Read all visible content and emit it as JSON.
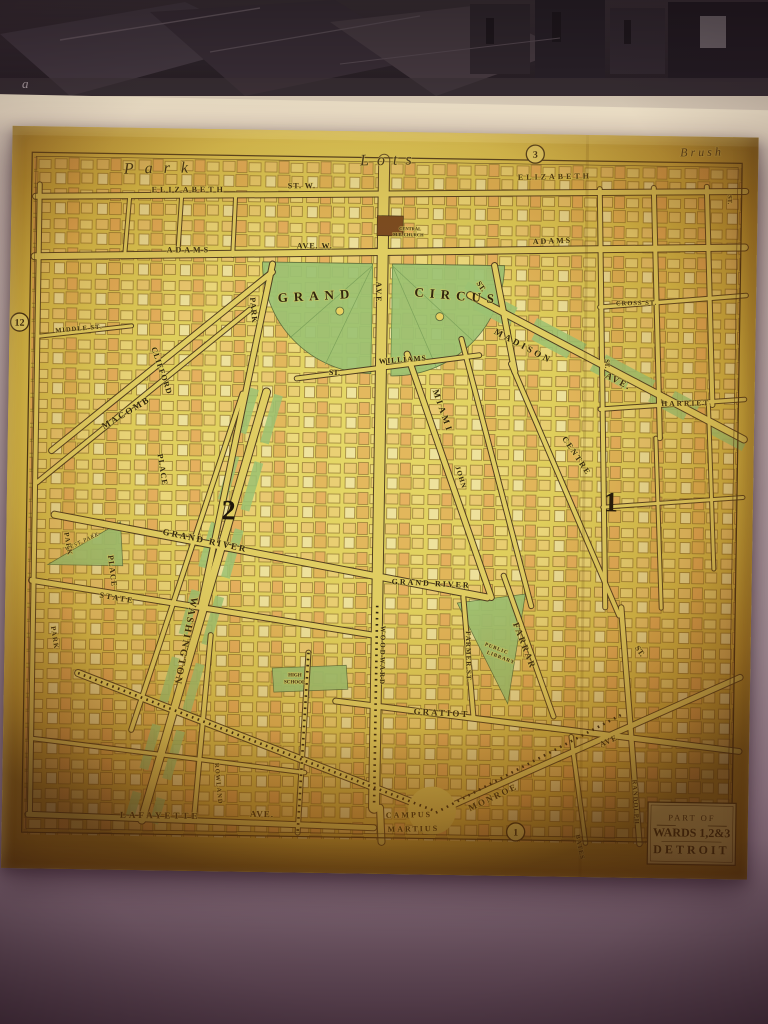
{
  "photo": {
    "mark": "a"
  },
  "map": {
    "cartouche": {
      "line1": "PART OF",
      "line2": "WARDS 1,2&3",
      "line3": "DETROIT"
    },
    "circled": [
      {
        "n": "3",
        "x": 523,
        "y": 20
      },
      {
        "n": "12",
        "x": 10,
        "y": 196
      },
      {
        "n": "1",
        "x": 514,
        "y": 698
      }
    ],
    "numerals": [
      {
        "n": "2",
        "x": 222,
        "y": 390
      },
      {
        "n": "1",
        "x": 604,
        "y": 376
      }
    ],
    "labels": [
      {
        "t": "Park",
        "x": 112,
        "y": 46,
        "r": -2,
        "s": 16,
        "it": 1,
        "sp": 11
      },
      {
        "t": "Lots",
        "x": 348,
        "y": 34,
        "r": -2,
        "s": 16,
        "it": 1,
        "sp": 8
      },
      {
        "t": "Brush",
        "x": 668,
        "y": 20,
        "r": -2,
        "s": 12,
        "it": 1,
        "sp": 3
      },
      {
        "t": "ELIZABETH",
        "x": 140,
        "y": 64,
        "r": -1,
        "s": 8,
        "sp": 3
      },
      {
        "t": "ST. W.",
        "x": 276,
        "y": 58,
        "r": -1,
        "s": 8,
        "sp": 1
      },
      {
        "t": "ELIZABETH",
        "x": 506,
        "y": 46,
        "r": -2,
        "s": 8,
        "sp": 3
      },
      {
        "t": "ADAMS",
        "x": 156,
        "y": 124,
        "r": -1,
        "s": 8,
        "sp": 3
      },
      {
        "t": "AVE. W.",
        "x": 286,
        "y": 118,
        "r": -1,
        "s": 8,
        "sp": 1
      },
      {
        "t": "ADAMS",
        "x": 522,
        "y": 110,
        "r": -3,
        "s": 8,
        "sp": 2
      },
      {
        "t": "GRAND",
        "x": 268,
        "y": 172,
        "r": -4,
        "s": 13,
        "sp": 6
      },
      {
        "t": "CIRCUS",
        "x": 404,
        "y": 164,
        "r": 4,
        "s": 13,
        "sp": 6
      },
      {
        "t": "MADISON",
        "x": 484,
        "y": 200,
        "r": 27,
        "s": 9,
        "sp": 3
      },
      {
        "t": "AVE.",
        "x": 596,
        "y": 242,
        "r": 27,
        "s": 9,
        "sp": 2
      },
      {
        "t": "CROSS ST.",
        "x": 606,
        "y": 170,
        "r": -2,
        "s": 6.5,
        "sp": 1
      },
      {
        "t": "HARRIET",
        "x": 653,
        "y": 270,
        "r": -2,
        "s": 7.5,
        "sp": 2
      },
      {
        "t": "ST.",
        "x": 320,
        "y": 244,
        "r": 0,
        "s": 8,
        "sp": 0
      },
      {
        "t": "WILLIAMS",
        "x": 370,
        "y": 232,
        "r": -5,
        "s": 7.5,
        "sp": 1
      },
      {
        "t": "ST.",
        "x": 466,
        "y": 150,
        "r": 55,
        "s": 7.5,
        "sp": 0
      },
      {
        "t": "MIAMI",
        "x": 424,
        "y": 258,
        "r": 70,
        "s": 9,
        "sp": 3
      },
      {
        "t": "JOHN",
        "x": 448,
        "y": 334,
        "r": 72,
        "s": 7,
        "sp": 1
      },
      {
        "t": "CENTRE",
        "x": 554,
        "y": 304,
        "r": 55,
        "s": 8,
        "sp": 2
      },
      {
        "t": "ST.",
        "x": 630,
        "y": 512,
        "r": 55,
        "s": 8,
        "sp": 0
      },
      {
        "t": "AVE",
        "x": 366,
        "y": 150,
        "r": 90,
        "s": 8,
        "sp": 2
      },
      {
        "t": "WOODWARD",
        "x": 376,
        "y": 494,
        "r": 90,
        "s": 7,
        "sp": 2
      },
      {
        "t": "PARK",
        "x": 240,
        "y": 168,
        "r": 84,
        "s": 8,
        "sp": 1
      },
      {
        "t": "CLIFFORD",
        "x": 142,
        "y": 220,
        "r": 70,
        "s": 8,
        "sp": 1
      },
      {
        "t": "MACOMB",
        "x": 96,
        "y": 302,
        "r": -32,
        "s": 9,
        "sp": 2
      },
      {
        "t": "MIDDLE ST.",
        "x": 46,
        "y": 206,
        "r": -6,
        "s": 6.5,
        "sp": 1
      },
      {
        "t": "PLACE",
        "x": 150,
        "y": 326,
        "r": 80,
        "s": 8,
        "sp": 1
      },
      {
        "t": "PLACE",
        "x": 102,
        "y": 428,
        "r": 82,
        "s": 8,
        "sp": 1
      },
      {
        "t": "PARK",
        "x": 58,
        "y": 406,
        "r": 80,
        "s": 7,
        "sp": 1
      },
      {
        "t": "PARK",
        "x": 46,
        "y": 500,
        "r": 80,
        "s": 7,
        "sp": 1
      },
      {
        "t": "WEST PARK",
        "x": 60,
        "y": 424,
        "r": -26,
        "s": 5.5,
        "it": 1,
        "sp": 1
      },
      {
        "t": "WASHINGTON",
        "x": 186,
        "y": 468,
        "r": 100,
        "s": 10,
        "sp": 2
      },
      {
        "t": "GRAND RIVER",
        "x": 156,
        "y": 406,
        "r": 11,
        "s": 9,
        "sp": 2
      },
      {
        "t": "GRAND RIVER",
        "x": 386,
        "y": 452,
        "r": 2,
        "s": 8,
        "sp": 2
      },
      {
        "t": "STATE",
        "x": 94,
        "y": 470,
        "r": 9,
        "s": 8,
        "sp": 2
      },
      {
        "t": "FARMER ST.",
        "x": 461,
        "y": 498,
        "r": 88,
        "s": 7,
        "sp": 1
      },
      {
        "t": "FARRAR",
        "x": 508,
        "y": 490,
        "r": 68,
        "s": 9,
        "sp": 2
      },
      {
        "t": "PUBLIC",
        "x": 480,
        "y": 512,
        "r": 20,
        "s": 5,
        "sp": 1
      },
      {
        "t": "LIBRARY",
        "x": 482,
        "y": 520,
        "r": 20,
        "s": 5,
        "sp": 1
      },
      {
        "t": "GRATIOT",
        "x": 410,
        "y": 582,
        "r": 2,
        "s": 9,
        "sp": 2
      },
      {
        "t": "MONROE",
        "x": 468,
        "y": 678,
        "r": -26,
        "s": 9,
        "sp": 2
      },
      {
        "t": "AVE",
        "x": 598,
        "y": 612,
        "r": -26,
        "s": 8,
        "sp": 1
      },
      {
        "t": "CAMPUS",
        "x": 384,
        "y": 686,
        "r": -2,
        "s": 8,
        "sp": 2
      },
      {
        "t": "MARTIUS",
        "x": 386,
        "y": 700,
        "r": -2,
        "s": 8,
        "sp": 2
      },
      {
        "t": "LAFAYETTE",
        "x": 118,
        "y": 690,
        "r": 0,
        "s": 9,
        "sp": 3
      },
      {
        "t": "AVE.",
        "x": 248,
        "y": 687,
        "r": 0,
        "s": 9,
        "sp": 1
      },
      {
        "t": "BATES",
        "x": 574,
        "y": 700,
        "r": 78,
        "s": 6.5,
        "sp": 1
      },
      {
        "t": "RANDOLPH",
        "x": 630,
        "y": 644,
        "r": 86,
        "s": 6.5,
        "sp": 1
      },
      {
        "t": "ROWLAND",
        "x": 212,
        "y": 634,
        "r": 84,
        "s": 6.5,
        "sp": 1
      },
      {
        "t": "HIGH",
        "x": 284,
        "y": 546,
        "r": 0,
        "s": 5,
        "sp": 0
      },
      {
        "t": "SCHOOL",
        "x": 280,
        "y": 553,
        "r": 0,
        "s": 5,
        "sp": 0
      },
      {
        "t": "CENTRAL",
        "x": 388,
        "y": 98,
        "r": 0,
        "s": 4.5,
        "sp": 0
      },
      {
        "t": "M.E. CHURCH",
        "x": 382,
        "y": 104,
        "r": 0,
        "s": 4.5,
        "sp": 0
      },
      {
        "t": "ST.",
        "x": 596,
        "y": 224,
        "r": 88,
        "s": 6.5,
        "sp": 0
      },
      {
        "t": "ST.",
        "x": 716,
        "y": 58,
        "r": 88,
        "s": 6.5,
        "sp": 0
      }
    ],
    "streets": [
      [
        28,
        58,
        28,
        688,
        4
      ],
      [
        24,
        70,
        734,
        54,
        5
      ],
      [
        24,
        130,
        734,
        110,
        6
      ],
      [
        118,
        70,
        114,
        128,
        3
      ],
      [
        170,
        68,
        167,
        127,
        3
      ],
      [
        224,
        66,
        222,
        126,
        3
      ],
      [
        588,
        54,
        600,
        472,
        4
      ],
      [
        642,
        52,
        652,
        302,
        4
      ],
      [
        695,
        50,
        704,
        268,
        4
      ],
      [
        648,
        302,
        656,
        472,
        3
      ],
      [
        700,
        268,
        708,
        432,
        3
      ],
      [
        590,
        172,
        736,
        158,
        3.5
      ],
      [
        592,
        274,
        736,
        262,
        3.5
      ],
      [
        596,
        372,
        736,
        360,
        3
      ],
      [
        372,
        28,
        372,
        676,
        10
      ],
      [
        378,
        676,
        380,
        710,
        6
      ],
      [
        262,
        134,
        196,
        476,
        5
      ],
      [
        484,
        132,
        506,
        238,
        5
      ],
      [
        288,
        248,
        470,
        222,
        4
      ],
      [
        398,
        222,
        486,
        464,
        5
      ],
      [
        452,
        206,
        526,
        472,
        4
      ],
      [
        502,
        230,
        614,
        480,
        4
      ],
      [
        460,
        162,
        736,
        302,
        6
      ],
      [
        262,
        142,
        44,
        324,
        5
      ],
      [
        240,
        180,
        30,
        356,
        4
      ],
      [
        28,
        210,
        122,
        198,
        3
      ],
      [
        234,
        264,
        128,
        602,
        4
      ],
      [
        258,
        262,
        140,
        692,
        7
      ],
      [
        26,
        454,
        372,
        504,
        5
      ],
      [
        48,
        388,
        482,
        464,
        6
      ],
      [
        74,
        546,
        432,
        678,
        6
      ],
      [
        26,
        688,
        372,
        696,
        5
      ],
      [
        206,
        506,
        192,
        692,
        4
      ],
      [
        304,
        522,
        296,
        702,
        4
      ],
      [
        28,
        612,
        302,
        642,
        3.5
      ],
      [
        458,
        464,
        470,
        584,
        4
      ],
      [
        498,
        442,
        550,
        582,
        4
      ],
      [
        332,
        570,
        736,
        614,
        5
      ],
      [
        434,
        680,
        736,
        540,
        5
      ],
      [
        616,
        472,
        638,
        708,
        4.5
      ],
      [
        568,
        602,
        584,
        708,
        3.5
      ]
    ],
    "rails": [
      [
        372,
        474,
        372,
        674
      ],
      [
        74,
        546,
        432,
        678
      ],
      [
        304,
        522,
        296,
        702
      ],
      [
        434,
        680,
        620,
        578
      ]
    ],
    "green_lines": [
      [
        270,
        265,
        152,
        695,
        9,
        "50 20"
      ],
      [
        246,
        259,
        128,
        689,
        9,
        "46 24"
      ],
      [
        456,
        152,
        690,
        271,
        8,
        "56 22"
      ],
      [
        465,
        172,
        736,
        310,
        8,
        "40 26"
      ]
    ],
    "park_paths": [
      "M362,132 L362,242 A110,110 0 0 1 252,132 Z",
      "M382,132 L494,132 A112,112 0 0 1 382,244 Z"
    ],
    "park_polys": [
      "42,438 114,394 117,438",
      "452,470 520,460 504,570",
      "268,538 342,534 344,558 270,562"
    ],
    "spokes": [
      [
        362,
        134,
        280,
        208
      ],
      [
        362,
        134,
        316,
        234
      ],
      [
        362,
        134,
        362,
        240
      ],
      [
        382,
        134,
        464,
        208
      ],
      [
        382,
        134,
        428,
        236
      ],
      [
        382,
        134,
        382,
        242
      ]
    ],
    "fountains": [
      [
        330,
        180,
        4
      ],
      [
        430,
        184,
        4
      ]
    ],
    "church_block": [
      366,
      84,
      26,
      20
    ],
    "seam_x": 575
  }
}
